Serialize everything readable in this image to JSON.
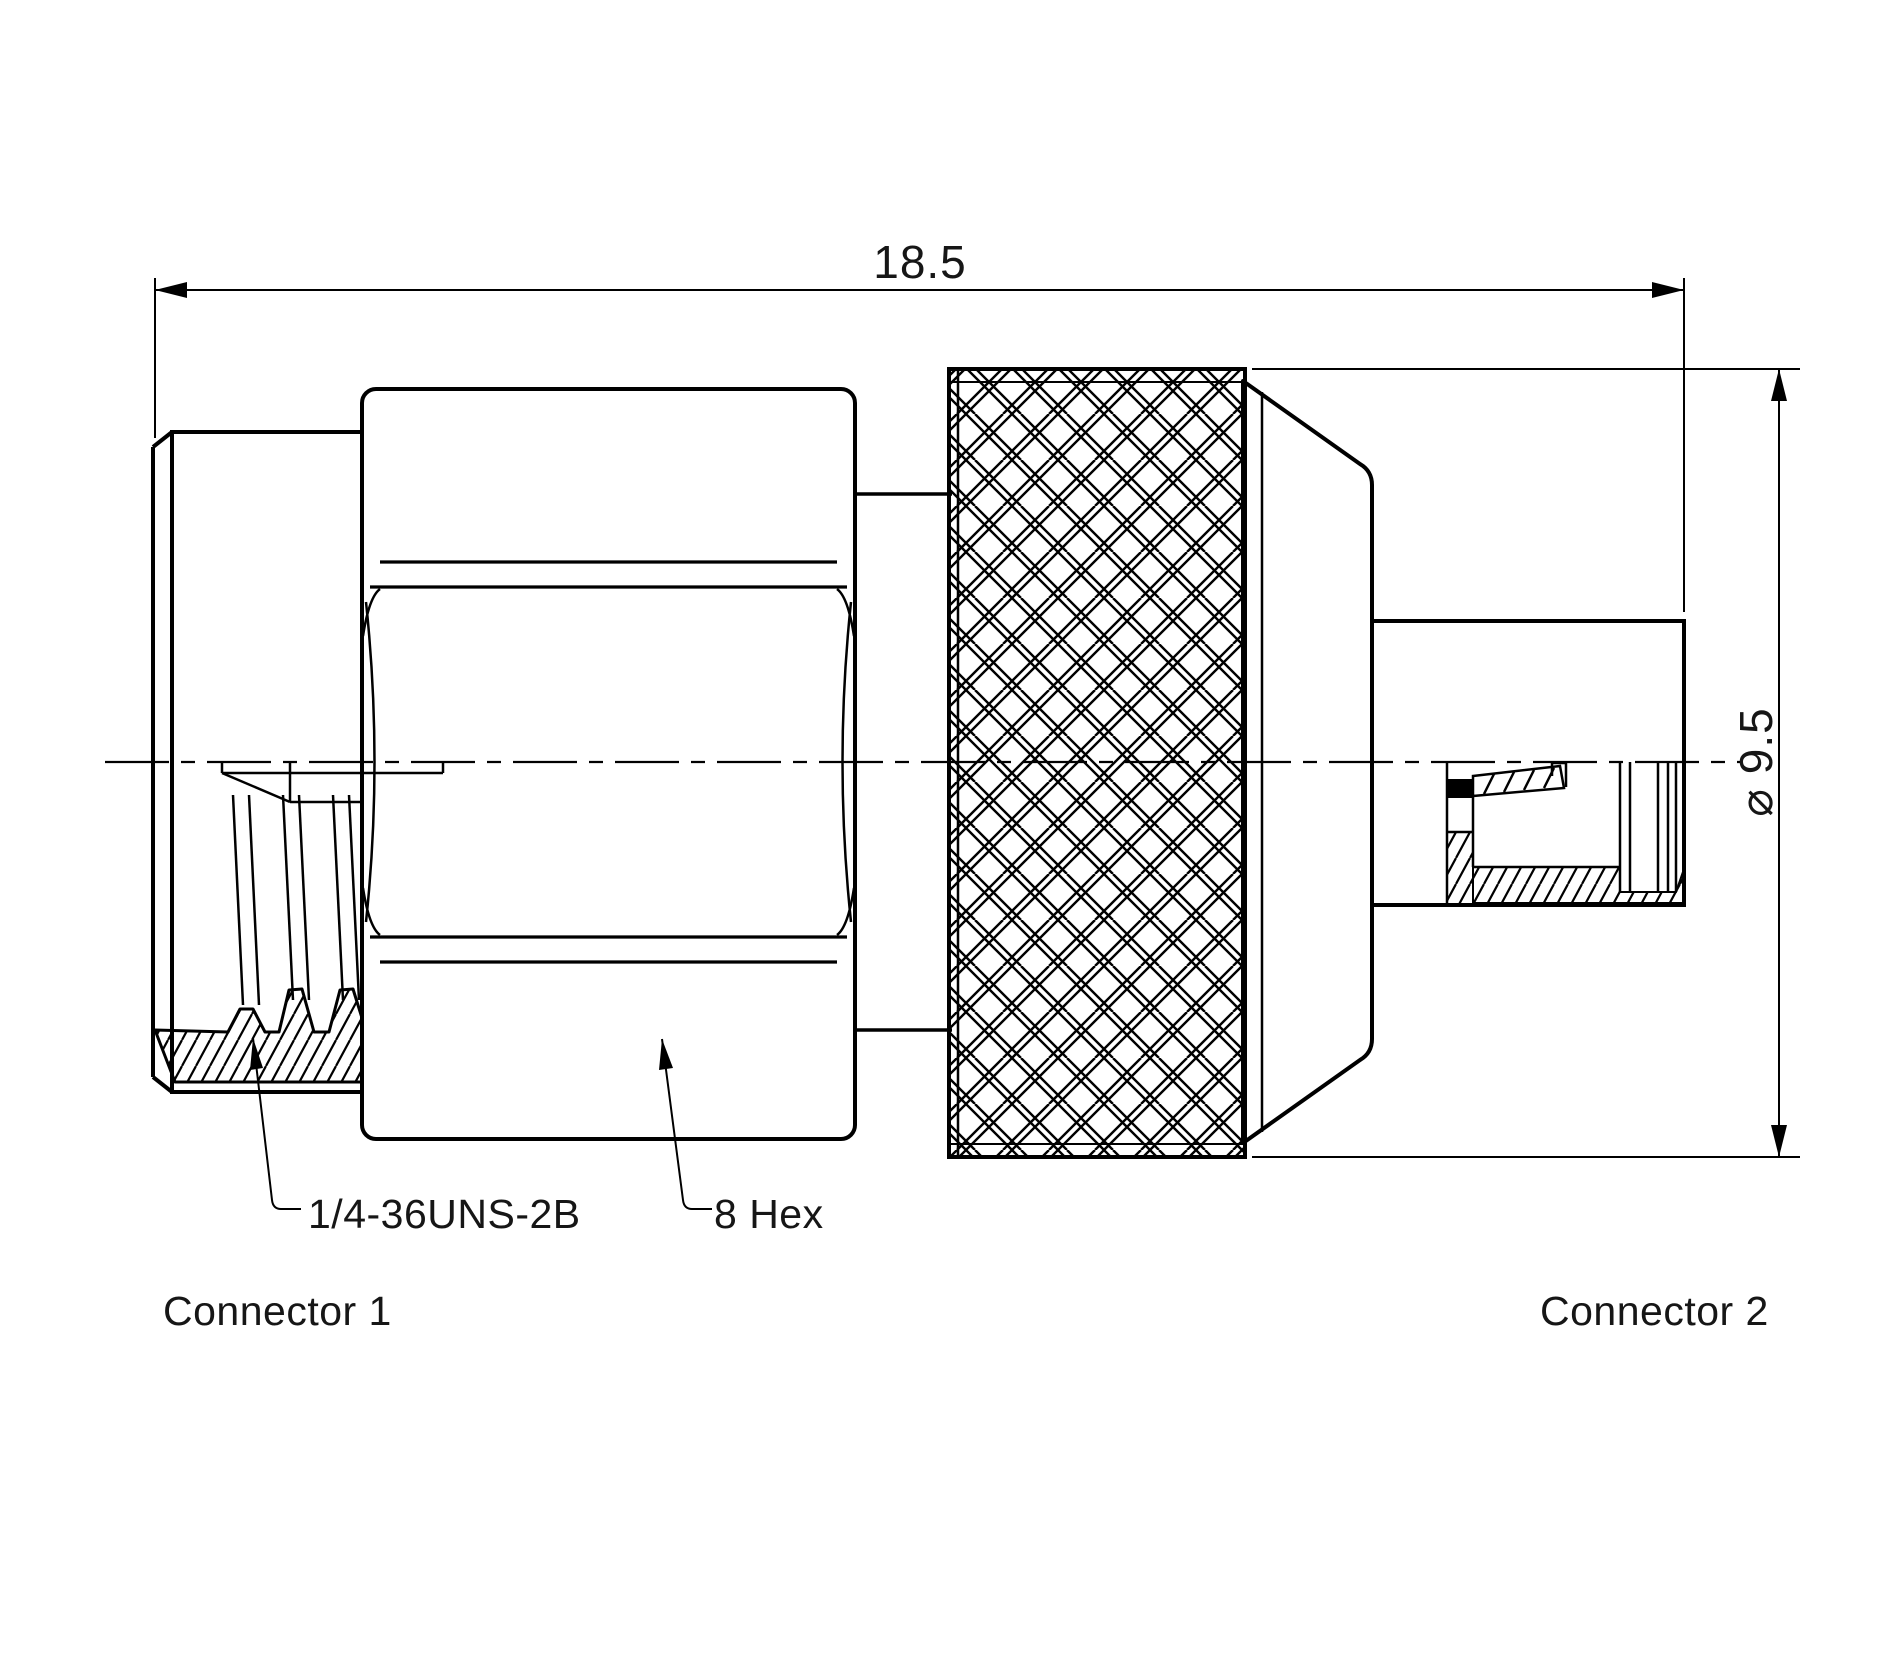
{
  "drawing": {
    "dimensions": {
      "overall_length": "18.5",
      "knurl_diameter": "⌀ 9.5"
    },
    "callouts": {
      "thread_spec": "1/4-36UNS-2B",
      "hex_size": "8 Hex"
    },
    "labels": {
      "connector1": "Connector 1",
      "connector2": "Connector 2"
    },
    "colors": {
      "line": "#000000",
      "background": "#ffffff"
    }
  }
}
